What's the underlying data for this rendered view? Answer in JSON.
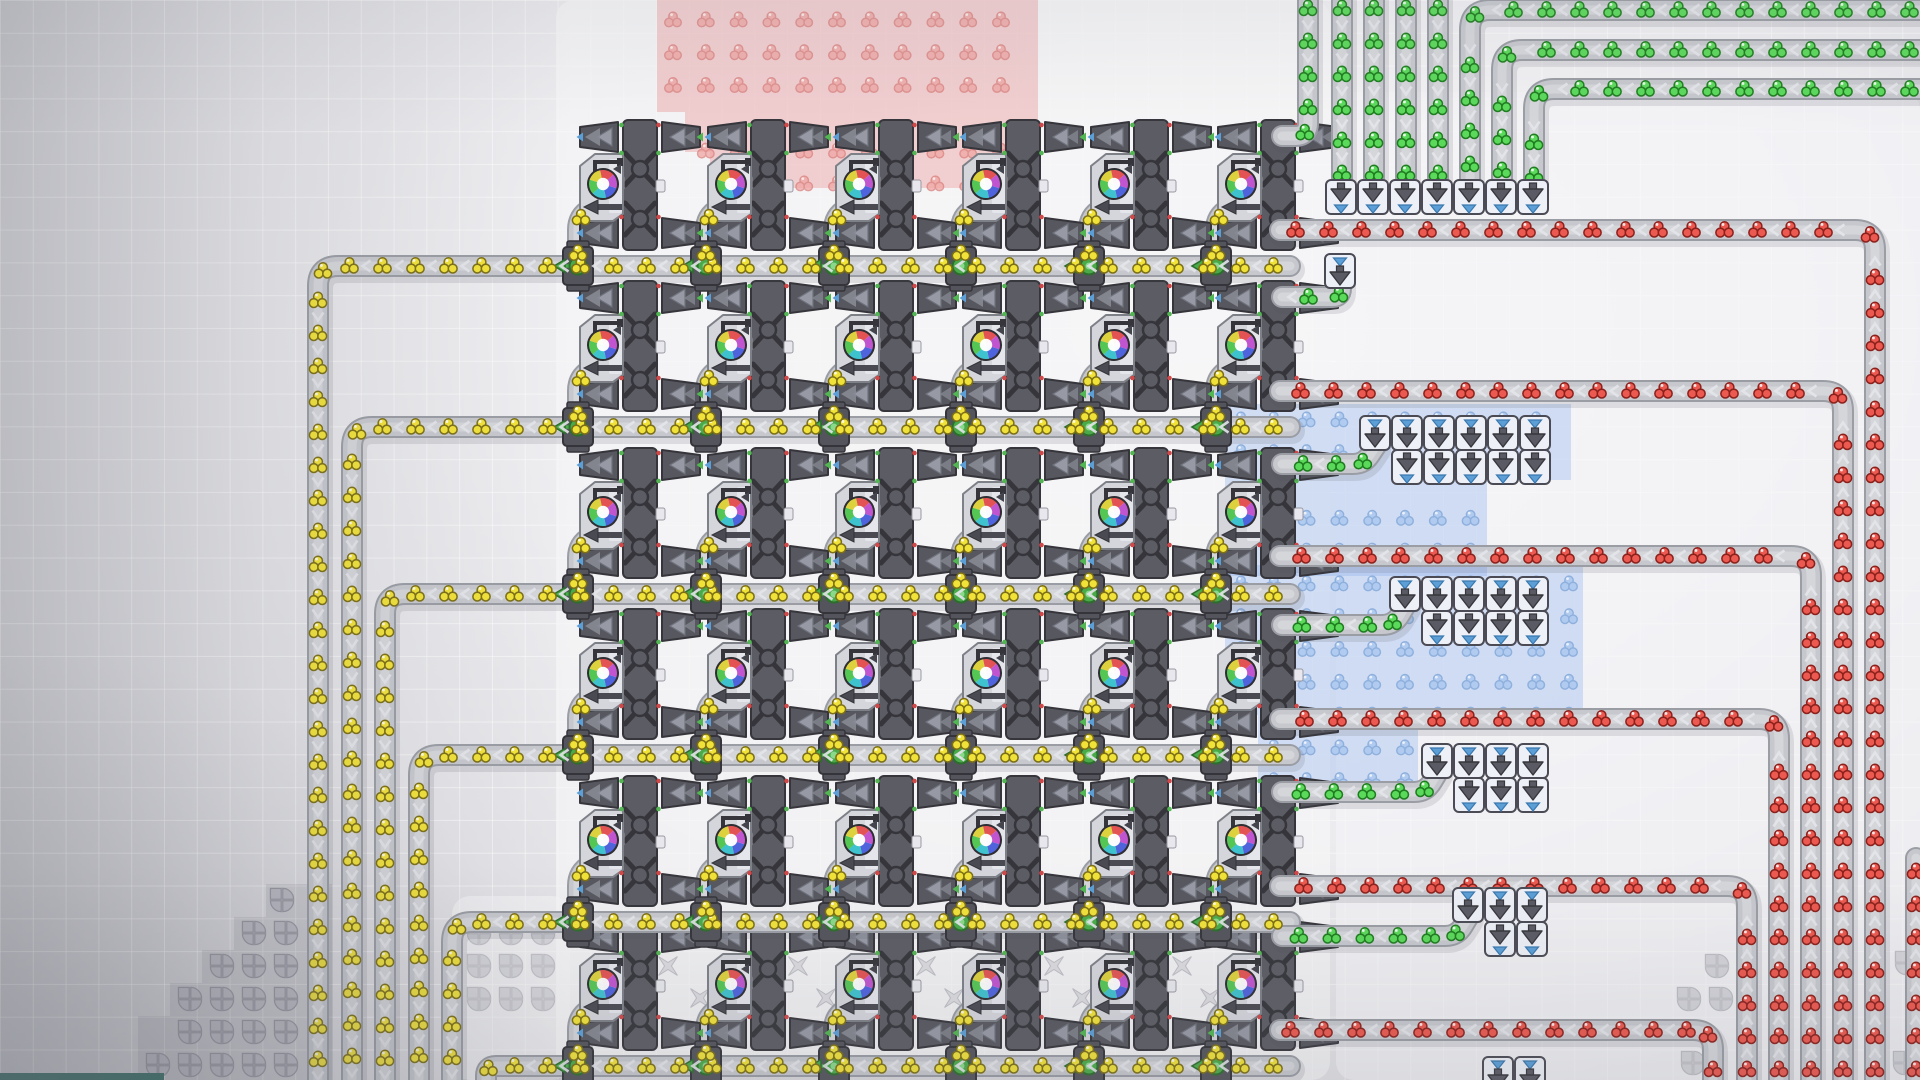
{
  "scene": {
    "width": 1920,
    "height": 1080,
    "grid_cell": 32.8,
    "game": "factory-builder"
  },
  "palette": {
    "belt_outer": "#9b9da5",
    "belt_mid": "#c6c8ce",
    "belt_lane": "#d4d6da",
    "belt_shadow": "rgba(80,80,95,0.14)",
    "chevron": "#e4e5ea",
    "machine_dark": "#5c5c64",
    "machine_outline": "#35353b",
    "machine_body": "#d5d5dc",
    "machine_body_edge": "#7e8088",
    "machine_inner": "#e7e7ed",
    "arrow_gray": "#979aa4",
    "arrow_gray_edge": "#6f727c",
    "tri_blue": "#5b9fd6",
    "tri_green": "#52b652",
    "splitter_green": "#4aaa4a",
    "splitter_green_dark": "#2d6d2d",
    "splitter_green_light": "#8ad88a",
    "box_fill": "#eef0f7",
    "box_edge": "#4b4b55",
    "box_arrow": "#5a5a64",
    "ghost_fill": "#b8b8c1",
    "ghost_edge": "#8e8e98",
    "cross_fill": "#cdcdd3",
    "cross_edge": "#9fa0a8",
    "blob_wedges": [
      "#e35353",
      "#c155cf",
      "#4f63dd",
      "#3ec2cd",
      "#54c654",
      "#ddd13e"
    ],
    "platform_fill": "#f5f5f7",
    "step_fill": "rgba(140,140,152,0.22)",
    "bottom_bar_fill": "#2e6a5e"
  },
  "items": {
    "yellow": {
      "fill": "#f1e23a",
      "stroke": "#7c6f15",
      "opacity": 1
    },
    "green": {
      "fill": "#5bd95b",
      "stroke": "#1e7d1e",
      "opacity": 1
    },
    "red": {
      "fill": "#ec5950",
      "stroke": "#8c211c",
      "opacity": 1
    },
    "ghost_red": {
      "fill": "#efa6a3",
      "stroke": "#d97f7c",
      "opacity": 0.75
    },
    "ghost_blue": {
      "fill": "#aac8f0",
      "stroke": "#7fa6d8",
      "opacity": 0.8
    }
  },
  "platforms": [
    [
      556,
      0,
      774,
      1080,
      0.72
    ],
    [
      452,
      896,
      118,
      184,
      0.6
    ],
    [
      1336,
      92,
      584,
      988,
      0.65
    ]
  ],
  "zones": [
    {
      "id": "landing-zone-red",
      "tint": "rgba(233,126,126,0.33)",
      "ghost": "ghost_red",
      "anchor": [
        673,
        20
      ],
      "rects": [
        [
          657,
          0,
          381,
          112
        ],
        [
          685,
          112,
          353,
          40
        ],
        [
          710,
          152,
          328,
          36
        ]
      ]
    },
    {
      "id": "landing-zone-blue-1",
      "tint": "rgba(138,174,238,0.33)",
      "ghost": "ghost_blue",
      "anchor": [
        1241,
        420
      ],
      "rects": [
        [
          1225,
          404,
          346,
          76
        ],
        [
          1225,
          480,
          262,
          96
        ]
      ]
    },
    {
      "id": "landing-zone-blue-2",
      "tint": "rgba(138,174,238,0.33)",
      "ghost": "ghost_blue",
      "anchor": [
        1241,
        420
      ],
      "rects": [
        [
          1225,
          565,
          358,
          150
        ]
      ]
    },
    {
      "id": "landing-zone-blue-3",
      "tint": "rgba(138,174,238,0.33)",
      "ghost": "ghost_blue",
      "anchor": [
        1241,
        420
      ],
      "rects": [
        [
          1258,
          715,
          160,
          78
        ]
      ]
    }
  ],
  "machines": {
    "columns_cx": [
      640,
      768,
      896,
      1023,
      1151,
      1278
    ],
    "row_tops": [
      120,
      281,
      448,
      609,
      776,
      920
    ]
  },
  "belts": [
    {
      "id": "yellow-row-1",
      "item": "yellow",
      "points": [
        [
          1290,
          266
        ],
        [
          318,
          266
        ],
        [
          318,
          1086
        ]
      ]
    },
    {
      "id": "yellow-row-2",
      "item": "yellow",
      "points": [
        [
          1290,
          427
        ],
        [
          352,
          427
        ],
        [
          352,
          1086
        ]
      ]
    },
    {
      "id": "yellow-row-3",
      "item": "yellow",
      "points": [
        [
          1290,
          594
        ],
        [
          385,
          594
        ],
        [
          385,
          1086
        ]
      ]
    },
    {
      "id": "yellow-row-4",
      "item": "yellow",
      "points": [
        [
          1290,
          755
        ],
        [
          419,
          755
        ],
        [
          419,
          1086
        ]
      ]
    },
    {
      "id": "yellow-row-5",
      "item": "yellow",
      "points": [
        [
          1290,
          922
        ],
        [
          452,
          922
        ],
        [
          452,
          1086
        ]
      ]
    },
    {
      "id": "yellow-row-6",
      "item": "yellow",
      "points": [
        [
          1290,
          1066
        ],
        [
          486,
          1066
        ],
        [
          486,
          1086
        ]
      ]
    },
    {
      "id": "red-loop-1",
      "item": "red",
      "points": [
        [
          1875,
          1086
        ],
        [
          1875,
          230
        ],
        [
          1280,
          230
        ]
      ]
    },
    {
      "id": "red-loop-2",
      "item": "red",
      "points": [
        [
          1843,
          1086
        ],
        [
          1843,
          391
        ],
        [
          1280,
          391
        ]
      ]
    },
    {
      "id": "red-loop-3",
      "item": "red",
      "points": [
        [
          1811,
          1086
        ],
        [
          1811,
          556
        ],
        [
          1280,
          556
        ]
      ]
    },
    {
      "id": "red-loop-4",
      "item": "red",
      "points": [
        [
          1779,
          1086
        ],
        [
          1779,
          719
        ],
        [
          1280,
          719
        ]
      ]
    },
    {
      "id": "red-loop-5",
      "item": "red",
      "points": [
        [
          1747,
          1086
        ],
        [
          1747,
          886
        ],
        [
          1280,
          886
        ]
      ]
    },
    {
      "id": "red-loop-6",
      "item": "red",
      "points": [
        [
          1713,
          1086
        ],
        [
          1713,
          1030
        ],
        [
          1280,
          1030
        ]
      ]
    },
    {
      "id": "red-edge",
      "item": "red",
      "points": [
        [
          1916,
          1086
        ],
        [
          1916,
          858
        ]
      ]
    },
    {
      "id": "green-v1",
      "item": "green",
      "points": [
        [
          1342,
          -8
        ],
        [
          1342,
          184
        ]
      ]
    },
    {
      "id": "green-v2",
      "item": "green",
      "points": [
        [
          1374,
          -8
        ],
        [
          1374,
          184
        ]
      ]
    },
    {
      "id": "green-v3",
      "item": "green",
      "points": [
        [
          1406,
          -8
        ],
        [
          1406,
          184
        ]
      ]
    },
    {
      "id": "green-v4",
      "item": "green",
      "points": [
        [
          1438,
          -8
        ],
        [
          1438,
          184
        ]
      ]
    },
    {
      "id": "green-l5",
      "item": "green",
      "points": [
        [
          1926,
          10
        ],
        [
          1470,
          10
        ],
        [
          1470,
          184
        ]
      ]
    },
    {
      "id": "green-l6",
      "item": "green",
      "points": [
        [
          1926,
          50
        ],
        [
          1502,
          50
        ],
        [
          1502,
          184
        ]
      ]
    },
    {
      "id": "green-l7",
      "item": "green",
      "points": [
        [
          1926,
          89
        ],
        [
          1534,
          89
        ],
        [
          1534,
          184
        ]
      ]
    },
    {
      "id": "green-m1",
      "item": "green",
      "points": [
        [
          1308,
          -8
        ],
        [
          1308,
          136
        ],
        [
          1282,
          136
        ]
      ]
    },
    {
      "id": "green-m2",
      "item": "green",
      "points": [
        [
          1341,
          280
        ],
        [
          1341,
          297
        ],
        [
          1282,
          297
        ]
      ]
    },
    {
      "id": "green-fa",
      "item": "green",
      "points": [
        [
          1376,
          446
        ],
        [
          1364,
          464
        ],
        [
          1282,
          464
        ]
      ]
    },
    {
      "id": "green-fb",
      "item": "green",
      "points": [
        [
          1406,
          605
        ],
        [
          1394,
          625
        ],
        [
          1282,
          625
        ]
      ]
    },
    {
      "id": "green-fc0",
      "item": "green",
      "points": [
        [
          1438,
          772
        ],
        [
          1426,
          792
        ],
        [
          1282,
          792
        ]
      ]
    },
    {
      "id": "green-fc",
      "item": "green",
      "points": [
        [
          1469,
          916
        ],
        [
          1457,
          936
        ],
        [
          1282,
          936
        ]
      ]
    }
  ],
  "launchers": [
    {
      "id": "launch-row-top",
      "x": 1326,
      "y": 180,
      "count": 7,
      "pitch": 32,
      "cells": [
        "out"
      ],
      "first_single": false
    },
    {
      "id": "catcher-single",
      "x": 1325,
      "y": 254,
      "count": 1,
      "pitch": 32,
      "cells": [
        "in"
      ],
      "first_single": false
    },
    {
      "id": "catch-row-a",
      "x": 1360,
      "y": 416,
      "count": 6,
      "pitch": 32,
      "cells": [
        "in",
        "out"
      ],
      "first_single": true
    },
    {
      "id": "catch-row-b",
      "x": 1390,
      "y": 577,
      "count": 5,
      "pitch": 32,
      "cells": [
        "in",
        "out"
      ],
      "first_single": true
    },
    {
      "id": "catch-row-c",
      "x": 1422,
      "y": 744,
      "count": 4,
      "pitch": 32,
      "cells": [
        "in",
        "out"
      ],
      "first_single": true
    },
    {
      "id": "catch-row-d",
      "x": 1453,
      "y": 888,
      "count": 3,
      "pitch": 32,
      "cells": [
        "in",
        "out"
      ],
      "first_single": true
    },
    {
      "id": "catch-row-e",
      "x": 1483,
      "y": 1057,
      "count": 2,
      "pitch": 32,
      "cells": [
        "in",
        "out"
      ],
      "first_single": false
    }
  ],
  "ghost_quads": [
    [
      282,
      900,
      0.85
    ],
    [
      254,
      933,
      0.85
    ],
    [
      286,
      933,
      0.85
    ],
    [
      222,
      966,
      0.85
    ],
    [
      254,
      966,
      0.85
    ],
    [
      286,
      966,
      0.85
    ],
    [
      190,
      999,
      0.85
    ],
    [
      222,
      999,
      0.85
    ],
    [
      254,
      999,
      0.85
    ],
    [
      286,
      999,
      0.85
    ],
    [
      190,
      1032,
      0.85
    ],
    [
      222,
      1032,
      0.85
    ],
    [
      254,
      1032,
      0.85
    ],
    [
      286,
      1032,
      0.85
    ],
    [
      158,
      1065,
      0.85
    ],
    [
      190,
      1065,
      0.85
    ],
    [
      222,
      1065,
      0.85
    ],
    [
      254,
      1065,
      0.85
    ],
    [
      286,
      1065,
      0.85
    ],
    [
      479,
      933,
      0.45
    ],
    [
      511,
      933,
      0.45
    ],
    [
      543,
      933,
      0.45
    ],
    [
      479,
      966,
      0.45
    ],
    [
      511,
      966,
      0.45
    ],
    [
      543,
      966,
      0.45
    ],
    [
      479,
      999,
      0.45
    ],
    [
      511,
      999,
      0.45
    ],
    [
      543,
      999,
      0.45
    ],
    [
      1717,
      966,
      0.5
    ],
    [
      1689,
      999,
      0.5
    ],
    [
      1721,
      999,
      0.5
    ],
    [
      1693,
      1063,
      0.5
    ],
    [
      1907,
      963,
      0.5
    ],
    [
      1905,
      1063,
      0.5
    ]
  ],
  "ghost_crosses": [
    [
      672,
      934
    ],
    [
      704,
      936
    ],
    [
      668,
      966
    ],
    [
      700,
      998
    ],
    [
      828,
      934
    ],
    [
      798,
      966
    ],
    [
      856,
      966
    ],
    [
      826,
      998
    ],
    [
      956,
      934
    ],
    [
      926,
      966
    ],
    [
      984,
      966
    ],
    [
      954,
      998
    ],
    [
      1084,
      934
    ],
    [
      1054,
      966
    ],
    [
      1112,
      966
    ],
    [
      1082,
      998
    ],
    [
      1212,
      934
    ],
    [
      1182,
      966
    ],
    [
      1240,
      966
    ],
    [
      1210,
      998
    ]
  ],
  "steps": [
    [
      266,
      884,
      66,
      33
    ],
    [
      234,
      917,
      98,
      33
    ],
    [
      202,
      950,
      130,
      33
    ],
    [
      170,
      983,
      162,
      33
    ],
    [
      138,
      1016,
      194,
      33
    ],
    [
      138,
      1049,
      194,
      31
    ]
  ],
  "bottom_bar": {
    "x": 0,
    "y": 1073,
    "w": 164,
    "h": 7
  }
}
